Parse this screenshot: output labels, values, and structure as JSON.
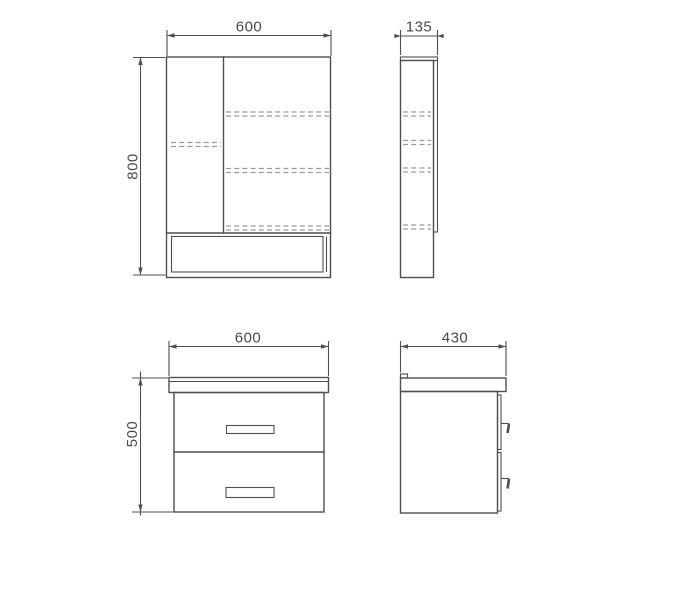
{
  "colors": {
    "line": "#4f4f4f",
    "dashed": "#9b9b9b",
    "text": "#4a4a4a",
    "bg": "#ffffff"
  },
  "views": {
    "mirror_front": {
      "width": "600",
      "height": "800"
    },
    "mirror_side": {
      "depth": "135"
    },
    "vanity_front": {
      "width": "600",
      "height": "500"
    },
    "vanity_side": {
      "depth": "430"
    }
  }
}
